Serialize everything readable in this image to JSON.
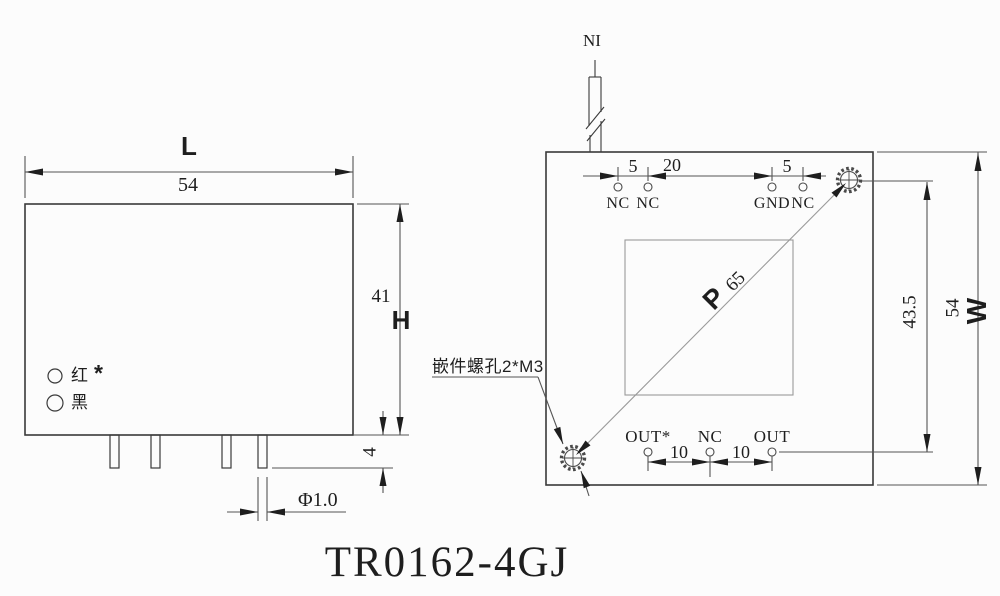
{
  "title": "TR0162-4GJ",
  "left_view": {
    "length_letter": "L",
    "length_value": "54",
    "height_letter": "H",
    "height_value": "41",
    "pin_length": "4",
    "pin_diameter": "Φ1.0",
    "wire_red": "红",
    "wire_red_mark": "*",
    "wire_black": "黑"
  },
  "right_view": {
    "input_label": "NI",
    "top_pin_labels": [
      "NC",
      "NC",
      "GND",
      "NC"
    ],
    "top_spacings": [
      "5",
      "20",
      "5"
    ],
    "bottom_pin_labels": [
      "OUT*",
      "NC",
      "OUT"
    ],
    "bottom_spacings": [
      "10",
      "10"
    ],
    "offset_value": "43.5",
    "width_value": "54",
    "width_letter": "W",
    "pitch_letter": "P",
    "pitch_value": "65",
    "screw_note": "嵌件螺孔2*M3"
  }
}
